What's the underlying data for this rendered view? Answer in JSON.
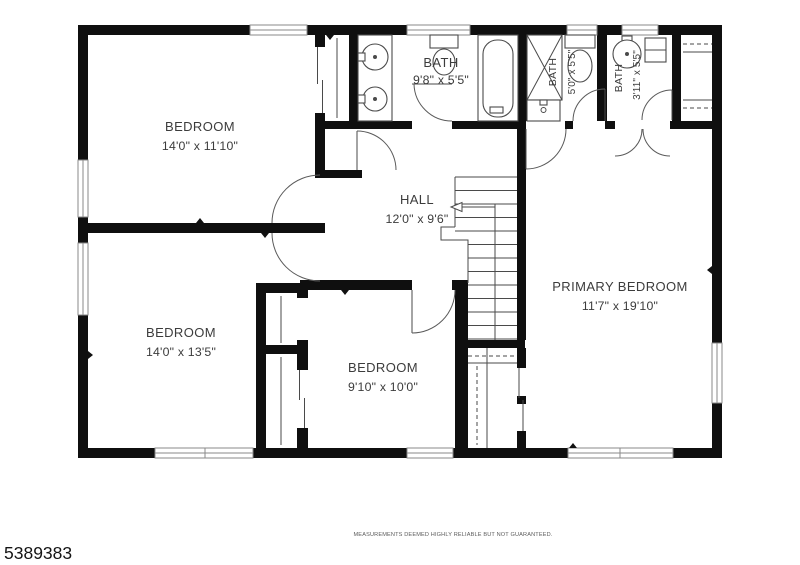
{
  "rooms": {
    "bedroom_top_left": {
      "name": "BEDROOM",
      "dims": "14'0\" x 11'10\""
    },
    "bath_main": {
      "name": "BATH",
      "dims": "9'8\" x 5'5\""
    },
    "bath_middle": {
      "name": "BATH",
      "dims": "5'0\" x 5'5\""
    },
    "bath_small": {
      "name": "BATH",
      "dims": "3'11\" x 5'5\""
    },
    "hall": {
      "name": "HALL",
      "dims": "12'0\" x 9'6\""
    },
    "primary_bedroom": {
      "name": "PRIMARY BEDROOM",
      "dims": "11'7\" x 19'10\""
    },
    "bedroom_bottom_left": {
      "name": "BEDROOM",
      "dims": "14'0\" x 13'5\""
    },
    "bedroom_bottom_middle": {
      "name": "BEDROOM",
      "dims": "9'10\" x 10'0\""
    }
  },
  "footer": {
    "disclaimer": "MEASUREMENTS DEEMED HIGHLY RELIABLE BUT NOT GUARANTEED.",
    "listing_id": "5389383"
  },
  "colors": {
    "wall": "#0f0f0f",
    "background": "#ffffff",
    "text": "#3c3c3c"
  }
}
